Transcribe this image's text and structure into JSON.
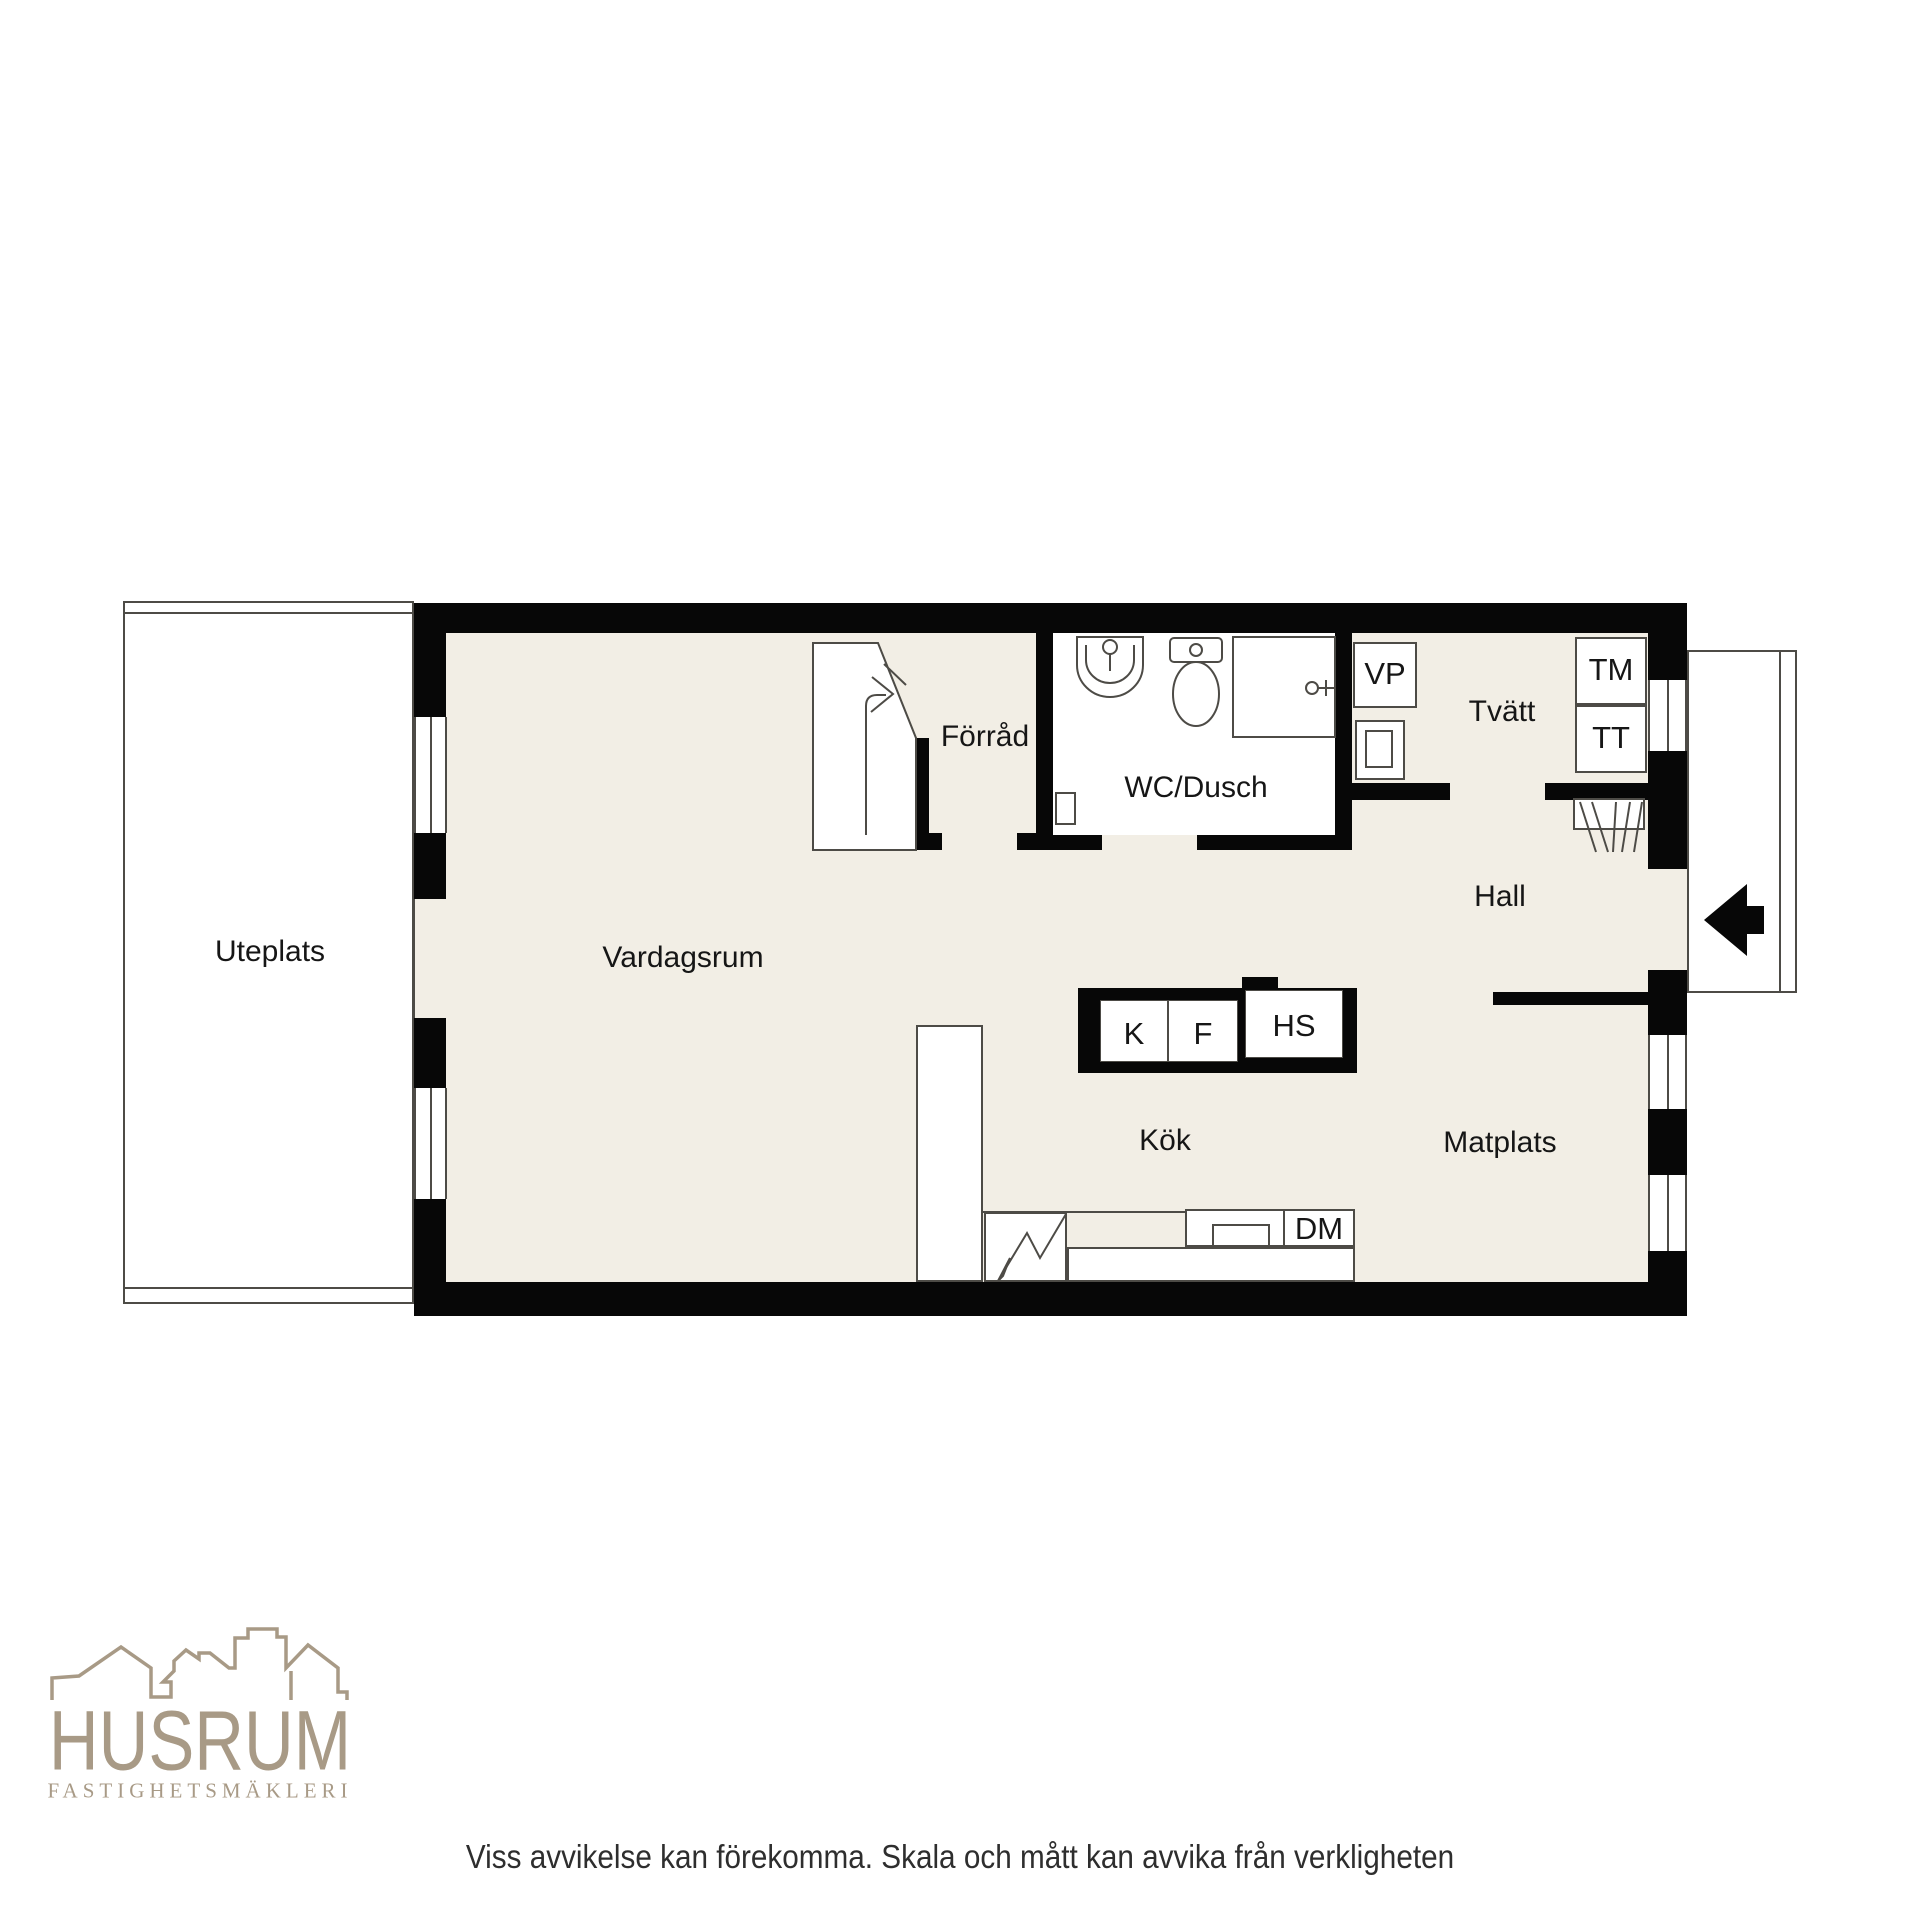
{
  "rooms": {
    "uteplats": "Uteplats",
    "vardagsrum": "Vardagsrum",
    "forrad": "Förråd",
    "wc_dusch": "WC/Dusch",
    "tvatt": "Tvätt",
    "hall": "Hall",
    "kok": "Kök",
    "matplats": "Matplats"
  },
  "units": {
    "vp": "VP",
    "tm": "TM",
    "tt": "TT",
    "k": "K",
    "f": "F",
    "hs": "HS",
    "dm": "DM"
  },
  "branding": {
    "logo": "HUSRUM",
    "tagline": "FASTIGHETSMÄKLERI"
  },
  "footer": {
    "disclaimer": "Viss avvikelse kan förekomma. Skala och mått kan avvika från verkligheten"
  },
  "colors": {
    "floor": "#f2eee5",
    "wall": "#070707",
    "line": "#4d4b46",
    "logo": "#a89a86",
    "ink": "#161616"
  }
}
